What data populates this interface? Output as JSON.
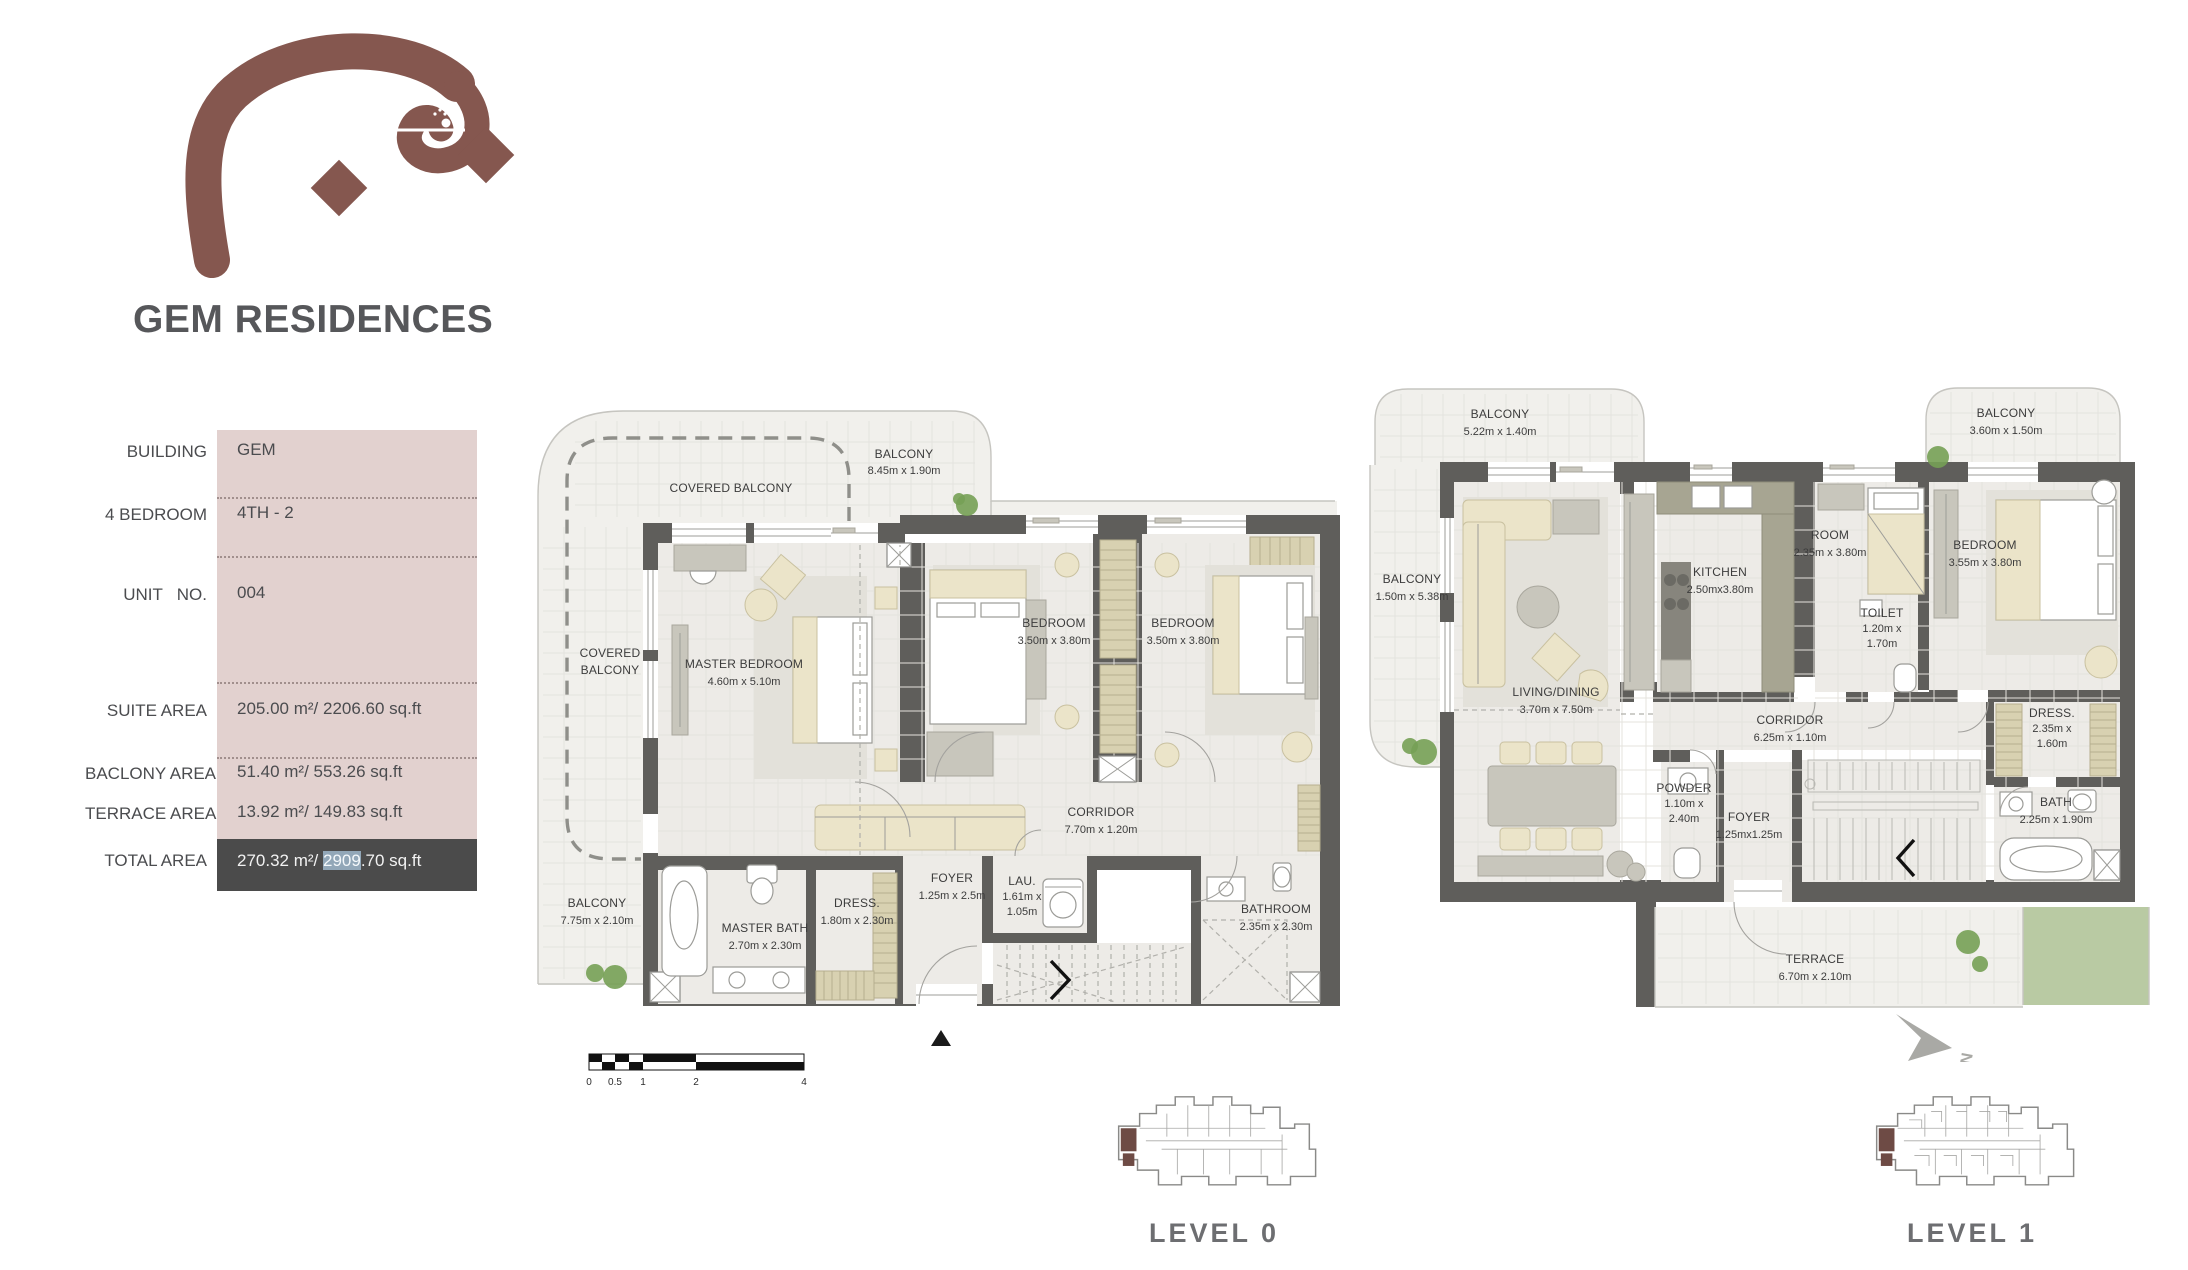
{
  "logo": {
    "arabic_word": "جيم",
    "arabic_subtext": "شقق"
  },
  "title": "GEM RESIDENCES",
  "info_table": {
    "rows": [
      {
        "label": "BUILDING",
        "value": "GEM"
      },
      {
        "label": "4 BEDROOM",
        "value": "4TH - 2"
      },
      {
        "label": "UNIT   NO.",
        "value": "004"
      },
      {
        "label": "SUITE AREA",
        "value": "205.00 m²/ 2206.60 sq.ft"
      },
      {
        "label": "BACLONY AREA",
        "value": "51.40 m²/ 553.26 sq.ft"
      },
      {
        "label": "TERRACE AREA",
        "value": "13.92 m²/ 149.83 sq.ft"
      }
    ],
    "total": {
      "label": "TOTAL AREA",
      "value_prefix": "270.32 m²/ ",
      "value_highlight": "2909",
      "value_suffix": ".70 sq.ft"
    }
  },
  "level0": {
    "caption": "LEVEL 0",
    "scale_bar": [
      "0",
      "0.5",
      "1",
      "2",
      "4"
    ],
    "rooms": [
      {
        "line1": "COVERED BALCONY"
      },
      {
        "line1": "BALCONY",
        "line2": "8.45m x 1.90m"
      },
      {
        "line1": "COVERED",
        "line2": "BALCONY"
      },
      {
        "line1": "MASTER BEDROOM",
        "line2": "4.60m x 5.10m"
      },
      {
        "line1": "BEDROOM",
        "line2": "3.50m x 3.80m"
      },
      {
        "line1": "BEDROOM",
        "line2": "3.50m x 3.80m"
      },
      {
        "line1": "CORRIDOR",
        "line2": "7.70m x 1.20m"
      },
      {
        "line1": "BALCONY",
        "line2": "7.75m x 2.10m"
      },
      {
        "line1": "MASTER BATH",
        "line2": "2.70m x 2.30m"
      },
      {
        "line1": "DRESS.",
        "line2": "1.80m x 2.30m"
      },
      {
        "line1": "FOYER",
        "line2": "1.25m x 2.5m"
      },
      {
        "line1": "LAU.",
        "line2": "1.61m x",
        "line3": "1.05m"
      },
      {
        "line1": "BATHROOM",
        "line2": "2.35m x 2.30m"
      }
    ]
  },
  "level1": {
    "caption": "LEVEL 1",
    "north_label": "N",
    "rooms": [
      {
        "line1": "BALCONY",
        "line2": "5.22m x 1.40m"
      },
      {
        "line1": "BALCONY",
        "line2": "1.50m x 5.38m"
      },
      {
        "line1": "BALCONY",
        "line2": "3.60m x 1.50m"
      },
      {
        "line1": "LIVING/DINING",
        "line2": "3.70m x 7.50m"
      },
      {
        "line1": "KITCHEN",
        "line2": "2.50mx3.80m"
      },
      {
        "line1": "ROOM",
        "line2": "2.35m x 3.80m"
      },
      {
        "line1": "BEDROOM",
        "line2": "3.55m x 3.80m"
      },
      {
        "line1": "TOILET",
        "line2": "1.20m x",
        "line3": "1.70m"
      },
      {
        "line1": "CORRIDOR",
        "line2": "6.25m x 1.10m"
      },
      {
        "line1": "DRESS.",
        "line2": "2.35m x",
        "line3": "1.60m"
      },
      {
        "line1": "BATH",
        "line2": "2.25m x 1.90m"
      },
      {
        "line1": "POWDER",
        "line2": "1.10m x",
        "line3": "2.40m"
      },
      {
        "line1": "FOYER",
        "line2": "1.25mx1.25m"
      },
      {
        "line1": "TERRACE",
        "line2": "6.70m x 2.10m"
      }
    ]
  }
}
